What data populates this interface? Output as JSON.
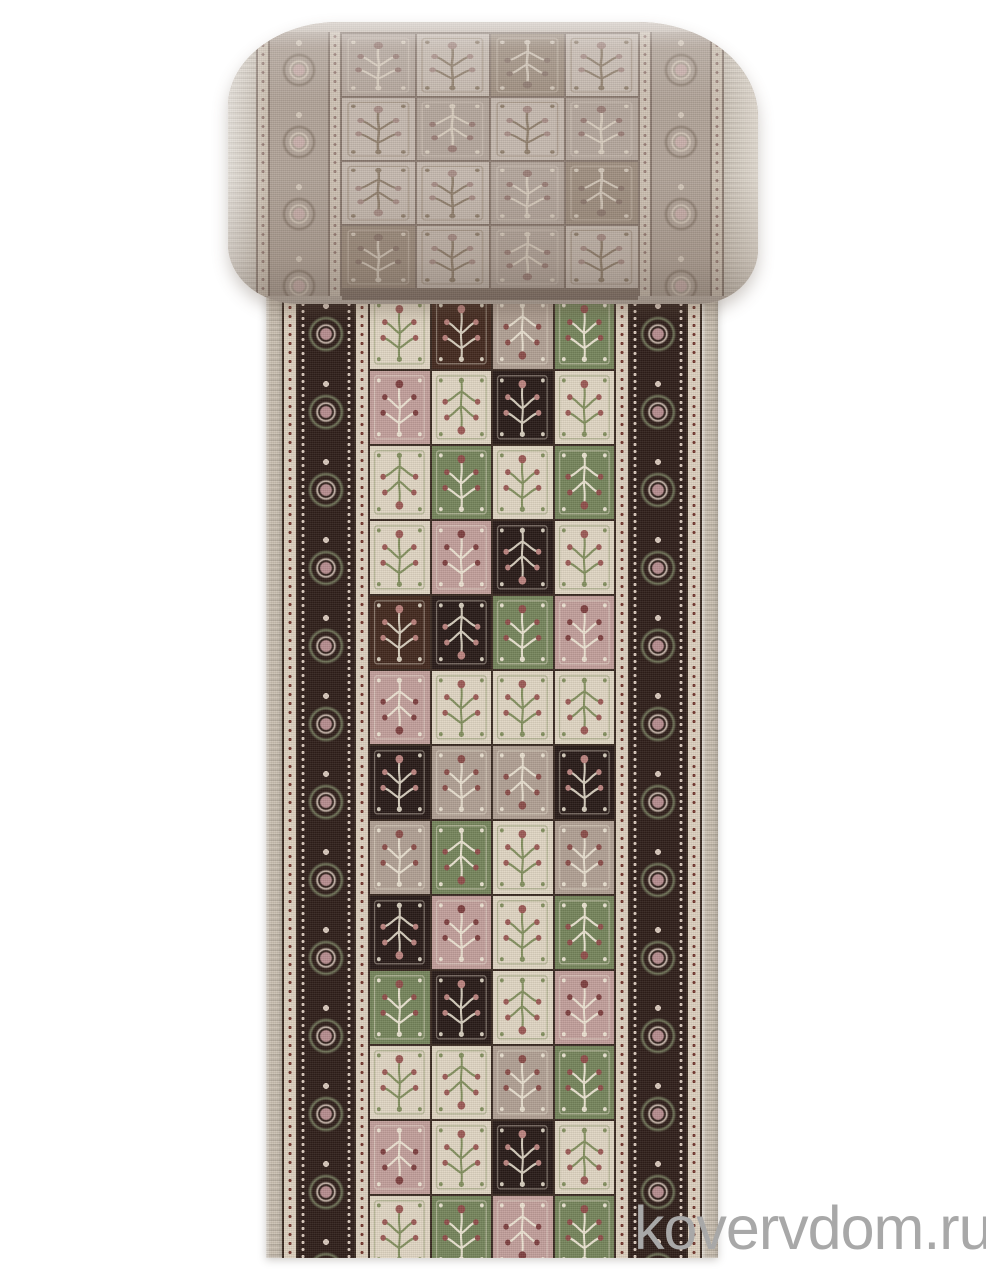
{
  "page": {
    "width": 986,
    "height": 1280,
    "background_color": "#ffffff"
  },
  "subject": {
    "label": "rolled-carpet-runner",
    "description": "Product photo of a beige oriental patchwork runner carpet, top portion rolled up showing the muted reverse-toned face, flat portion below showing the vivid patchwork face, cropped at the bottom edge"
  },
  "watermark": {
    "text": "kovervdom.ru",
    "color": "#a8a8a8"
  },
  "palette": {
    "grout": "#3a2a22",
    "grout_muted": "#8a7a70",
    "border_dark": "#2f1f1a",
    "border_flower": "#b78d8f",
    "border_flower_light": "#d8c7bb",
    "guard_bg": "#ddd1bf",
    "guard_dot": "#74382e",
    "selvage": "#c8bdae",
    "roll_base": "#c3b7ac",
    "roll_border_bg": "#b2a499",
    "roll_border_flower": "#c9b0ab",
    "roll_guard_bg": "#cfc3b5",
    "roll_guard_dot": "#9a8078",
    "roll_edge": "#ccc2b6",
    "watermark_color": "#a8a8a8",
    "colorways": {
      "cream": {
        "bg": "#e0d6c3",
        "accent": "#83905f",
        "detail": "#9c5a56"
      },
      "rose": {
        "bg": "#c29f9b",
        "accent": "#ece2d2",
        "detail": "#7e4040"
      },
      "taupe": {
        "bg": "#b1a094",
        "accent": "#e8dfcf",
        "detail": "#8a4d49"
      },
      "green": {
        "bg": "#76855c",
        "accent": "#eae3d1",
        "detail": "#8f4e4a"
      },
      "dark": {
        "bg": "#43291f",
        "accent": "#d8cebd",
        "detail": "#b97f7a"
      },
      "black": {
        "bg": "#281b18",
        "accent": "#d6cdbd",
        "detail": "#bb837f"
      },
      "m1": {
        "bg": "#c6bab0",
        "accent": "#92816f",
        "detail": "#a88e87"
      },
      "m2": {
        "bg": "#b5a79d",
        "accent": "#d8ccbe",
        "detail": "#9b7f78"
      },
      "m3": {
        "bg": "#a09081",
        "accent": "#d2c6b8",
        "detail": "#8e7a70"
      }
    }
  },
  "roll": {
    "grid": [
      [
        "m2",
        "m1",
        "m3",
        "m1"
      ],
      [
        "m1",
        "m2",
        "m1",
        "m2"
      ],
      [
        "m1",
        "m1",
        "m2",
        "m3"
      ],
      [
        "m3",
        "m1",
        "m2",
        "m1"
      ]
    ]
  },
  "runner": {
    "grid": [
      [
        "cream",
        "dark",
        "taupe",
        "green"
      ],
      [
        "rose",
        "cream",
        "black",
        "cream"
      ],
      [
        "cream",
        "green",
        "cream",
        "green"
      ],
      [
        "cream",
        "rose",
        "black",
        "cream"
      ],
      [
        "dark",
        "black",
        "green",
        "rose"
      ],
      [
        "rose",
        "cream",
        "cream",
        "cream"
      ],
      [
        "black",
        "taupe",
        "taupe",
        "black"
      ],
      [
        "taupe",
        "green",
        "cream",
        "taupe"
      ],
      [
        "black",
        "rose",
        "cream",
        "green"
      ],
      [
        "green",
        "black",
        "cream",
        "rose"
      ],
      [
        "cream",
        "cream",
        "taupe",
        "green"
      ],
      [
        "rose",
        "cream",
        "black",
        "cream"
      ],
      [
        "cream",
        "green",
        "rose",
        "green"
      ],
      [
        "taupe",
        "dark",
        "cream",
        "rose"
      ]
    ]
  }
}
